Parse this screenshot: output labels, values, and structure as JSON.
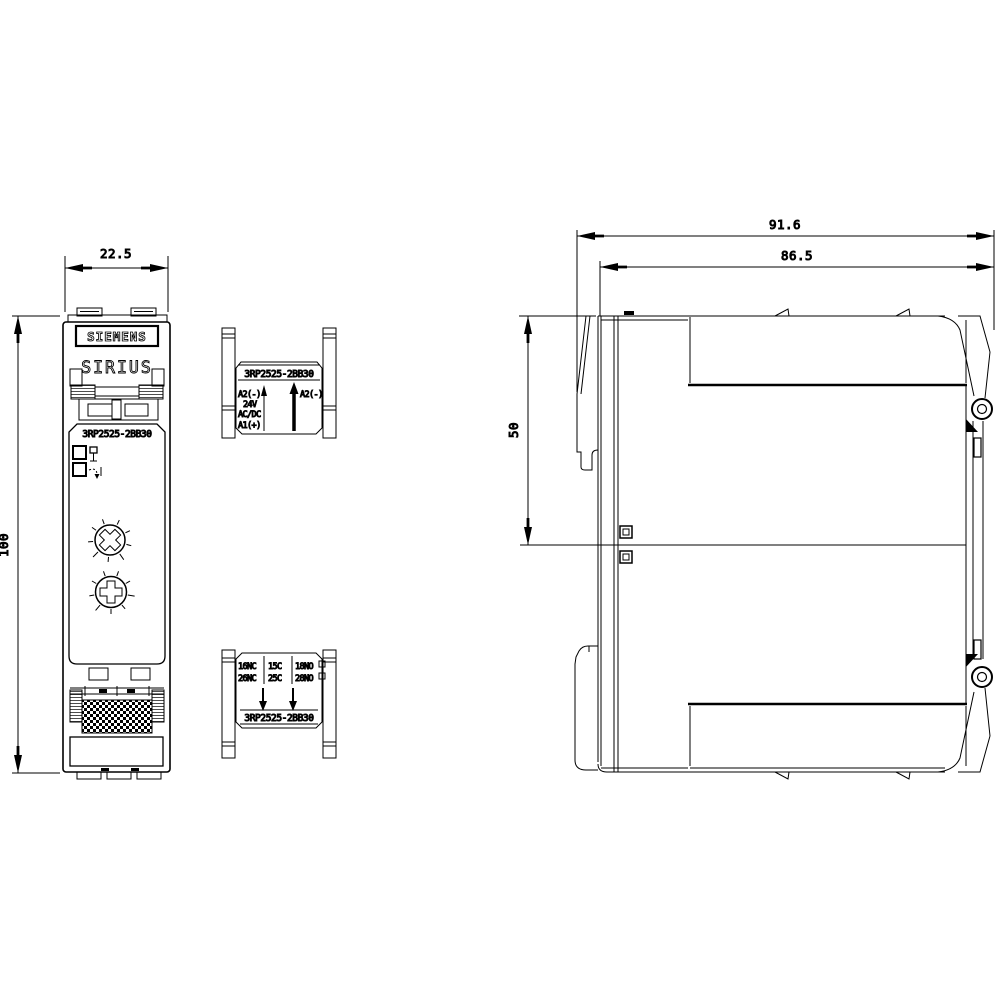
{
  "front_view": {
    "brand_label": "SIEMENS",
    "series_label": "SIRIUS",
    "product_code": "3RP2525-2BB30"
  },
  "top_terminal_block": {
    "product_code": "3RP2525-2BB30",
    "left_labels": [
      "A2(-)",
      "24V",
      "AC/DC",
      "A1(+)"
    ],
    "right_label": "A2(-)"
  },
  "bottom_terminal_block": {
    "row1_labels": [
      "16NC",
      "15C",
      "18NO"
    ],
    "row2_labels": [
      "26NC",
      "25C",
      "28NO"
    ],
    "product_code": "3RP2525-2BB30"
  },
  "dimensions_mm": {
    "width": "22.5",
    "height": "100",
    "depth_overall": "91.6",
    "depth_body": "86.5",
    "front_section_height": "50"
  },
  "colors": {
    "line": "#000000",
    "background": "#ffffff"
  }
}
